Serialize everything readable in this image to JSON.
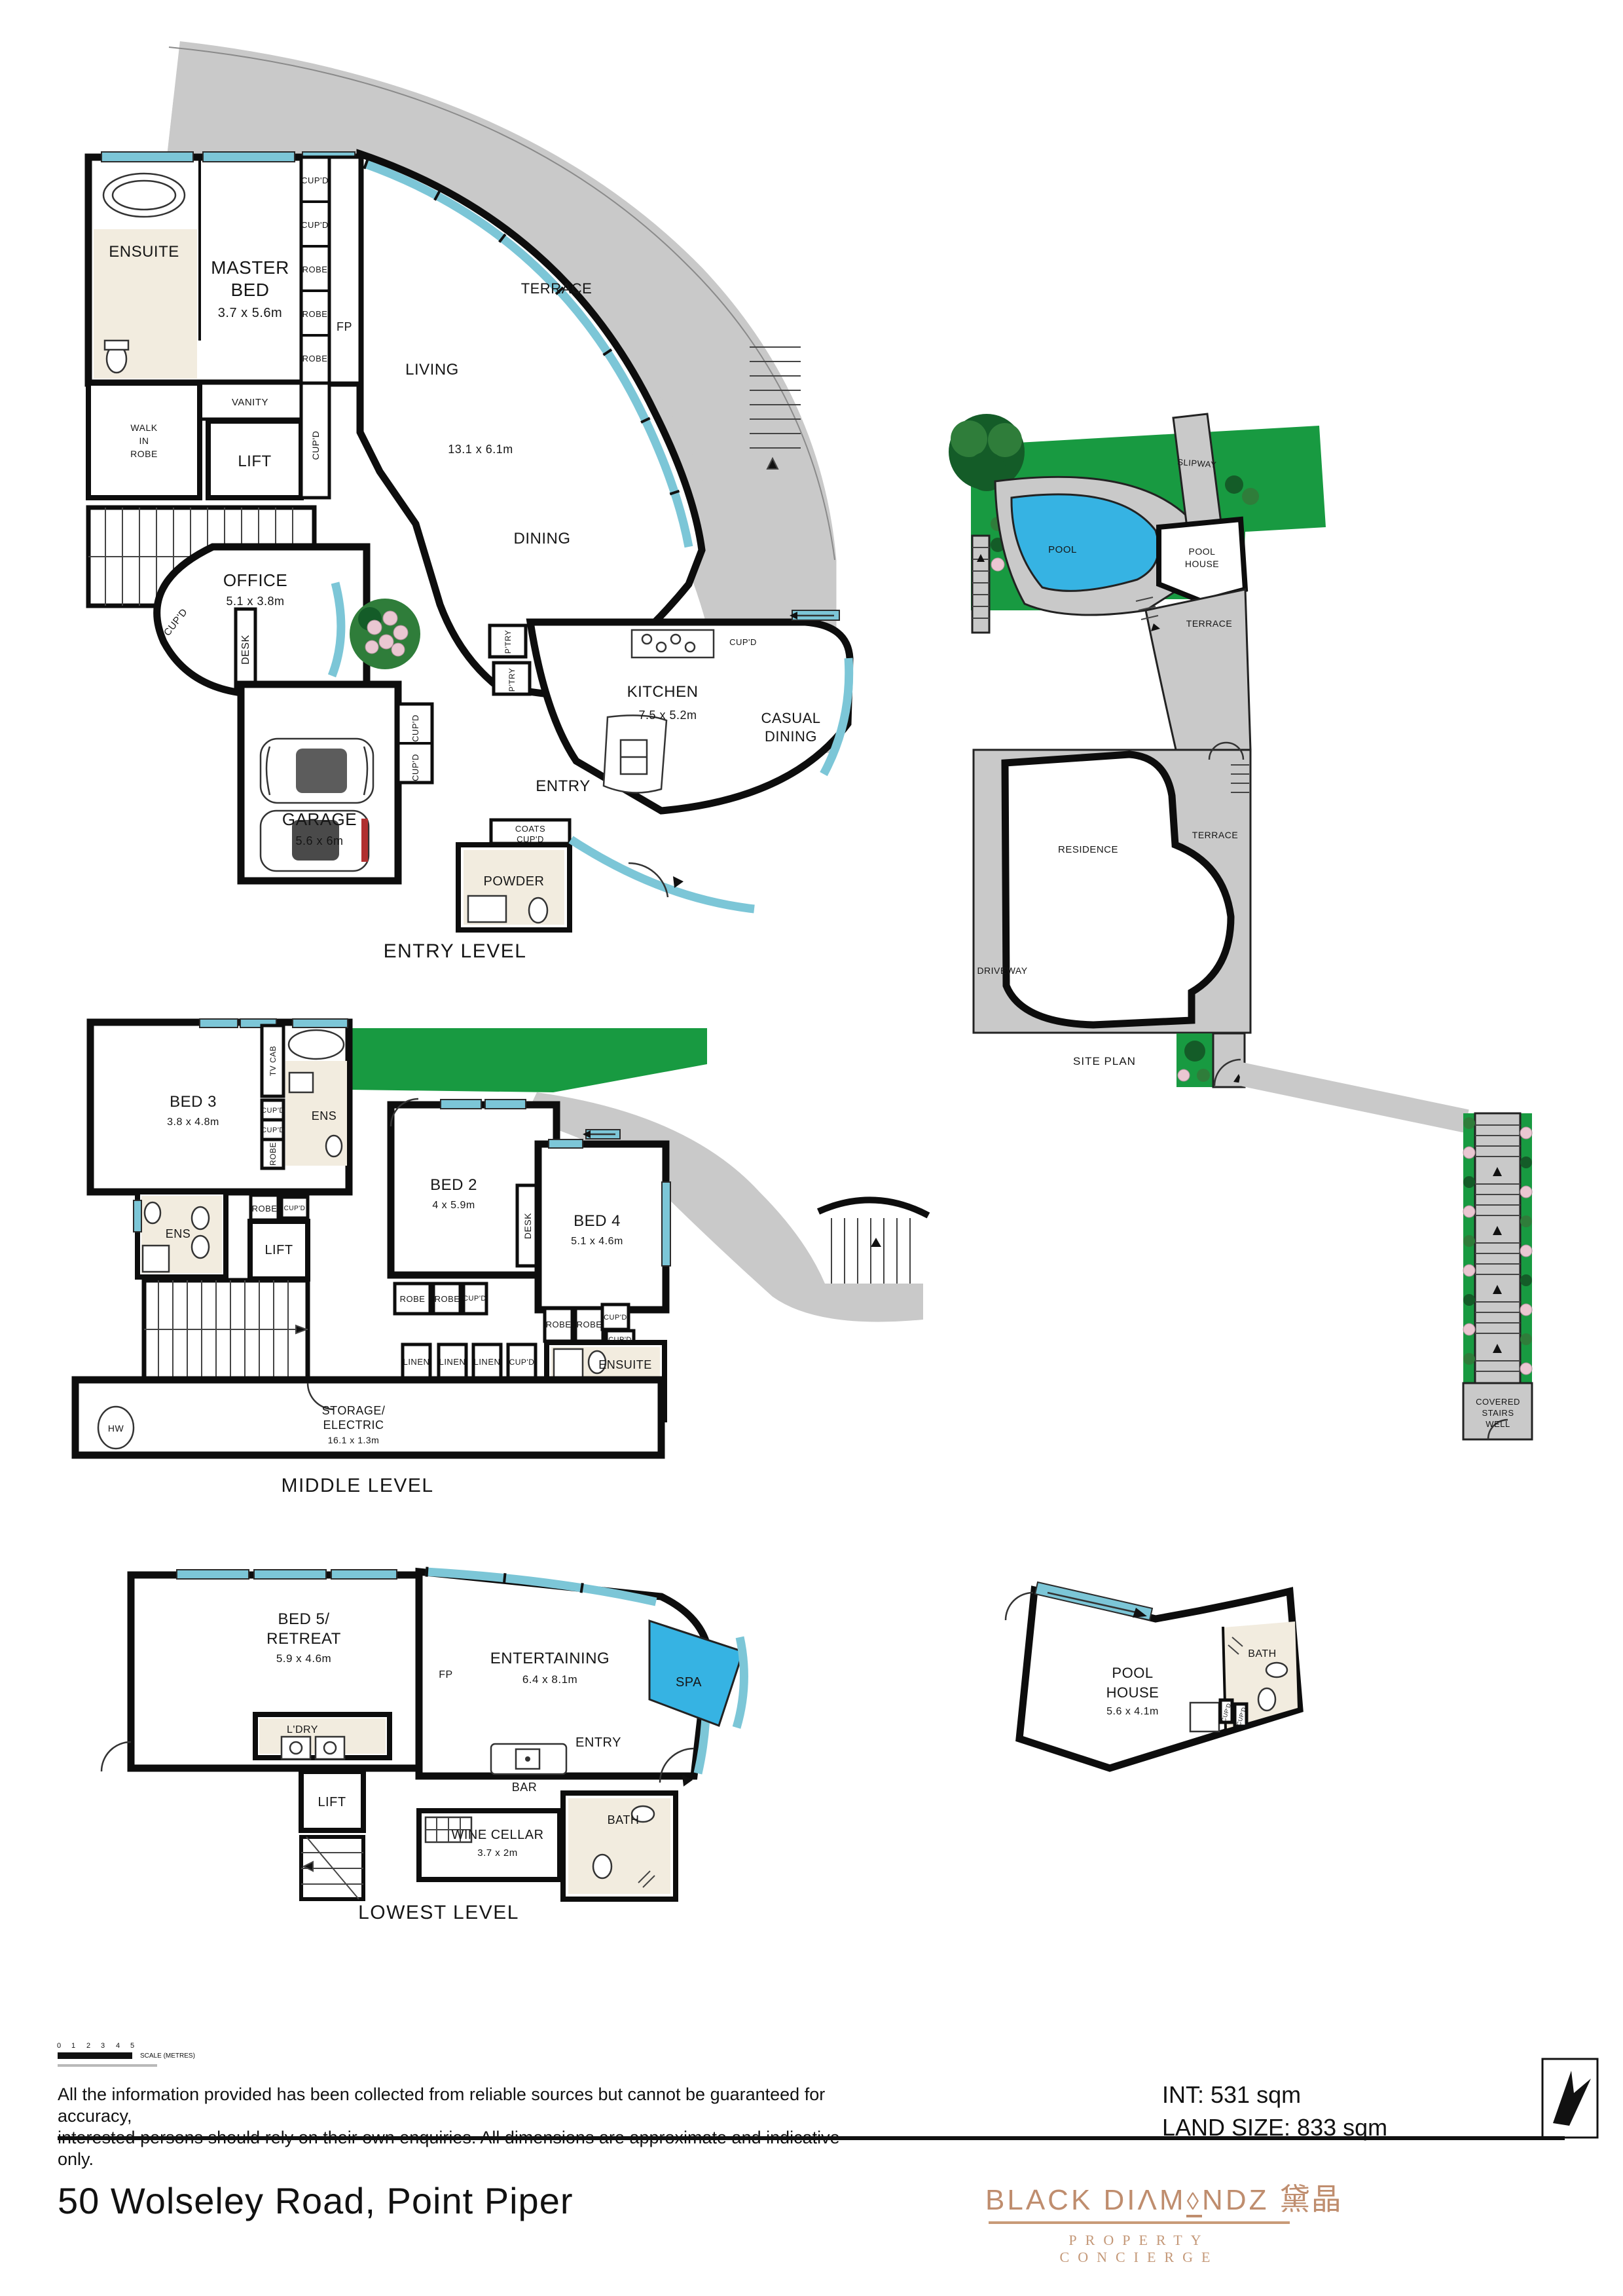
{
  "labels": {
    "cupd": "CUP'D",
    "robe": "ROBE",
    "linen": "LINEN",
    "ens": "ENS",
    "ensuite": "ENSUITE",
    "lift": "LIFT",
    "fp": "FP",
    "desk": "DESK",
    "bath": "BATH",
    "entry": "ENTRY",
    "terrace": "TERRACE",
    "ptry": "P'TRY",
    "tv_cab": "TV CAB",
    "hw": "HW",
    "vanity": "VANITY",
    "dining": "DINING",
    "living": "LIVING",
    "kitchen": "KITCHEN",
    "powder": "POWDER",
    "garage": "GARAGE",
    "office": "OFFICE",
    "spa": "SPA",
    "bar": "BAR",
    "ldry": "L'DRY",
    "slipway": "SLIPWAY",
    "pool": "POOL",
    "house": "HOUSE",
    "residence": "RESIDENCE",
    "driveway": "DRIVEWAY"
  },
  "entry_level": {
    "title": "ENTRY LEVEL",
    "master_1": "MASTER",
    "master_2": "BED",
    "master_dims": "3.7 x 5.6m",
    "walk_1": "WALK",
    "walk_2": "IN",
    "walk_3": "ROBE",
    "living_dims": "13.1 x 6.1m",
    "office_dims": "5.1 x 3.8m",
    "kitchen_dims": "7.5 x 5.2m",
    "casual_1": "CASUAL",
    "casual_2": "DINING",
    "garage_dims": "5.6 x 6m",
    "coats_1": "COATS",
    "coats_2": "CUP'D"
  },
  "middle_level": {
    "title": "MIDDLE LEVEL",
    "bed3": "BED 3",
    "bed3_dims": "3.8 x 4.8m",
    "bed2": "BED 2",
    "bed2_dims": "4 x 5.9m",
    "bed4": "BED 4",
    "bed4_dims": "5.1 x 4.6m",
    "storage_1": "STORAGE/",
    "storage_2": "ELECTRIC",
    "storage_dims": "16.1 x 1.3m"
  },
  "lowest_level": {
    "title": "LOWEST LEVEL",
    "bed5_1": "BED 5/",
    "bed5_2": "RETREAT",
    "bed5_dims": "5.9 x 4.6m",
    "entertaining": "ENTERTAINING",
    "entertaining_dims": "6.4 x 8.1m",
    "wine": "WINE CELLAR",
    "wine_dims": "3.7 x 2m"
  },
  "site_plan": {
    "title": "SITE PLAN",
    "covered_1": "COVERED",
    "covered_2": "STAIRS",
    "covered_3": "WELL"
  },
  "pool_house": {
    "dims": "5.6 x 4.1m"
  },
  "footer": {
    "scale_ticks": [
      "0",
      "1",
      "2",
      "3",
      "4",
      "5"
    ],
    "scale_caption": "SCALE (METRES)",
    "disclaimer_1": "All the information provided has been collected from reliable sources but cannot be guaranteed for accuracy,",
    "disclaimer_2": "interested persons should rely on their own enquiries. All dimensions are approximate and indicative only.",
    "int_area": "INT: 531 sqm",
    "land_size": "LAND SIZE: 833 sqm",
    "address": "50 Wolseley Road, Point Piper"
  },
  "brand": {
    "name_left": "BLACK DIΛM",
    "diamond": "◊",
    "name_right": "NDZ",
    "cn": "黛晶",
    "tagline": "PROPERTY CONCIERGE"
  },
  "colors": {
    "window": "#7cc6d7",
    "terrace": "#c9c9c9",
    "lawn": "#189a41",
    "pool": "#36b3e3",
    "logo": "#bf8d6e"
  }
}
